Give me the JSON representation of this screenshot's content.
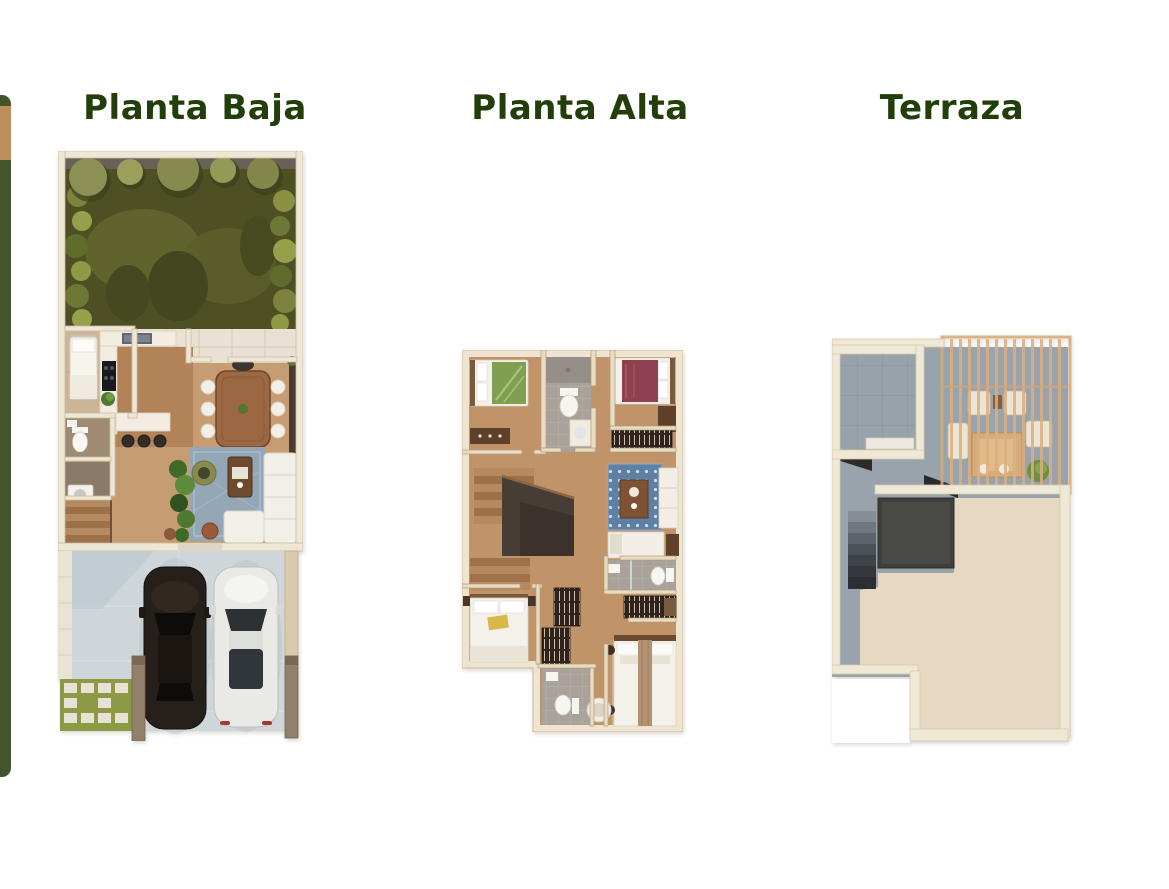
{
  "page": {
    "background": "#ffffff"
  },
  "plans": [
    {
      "id": "planta-baja",
      "title": "Planta Baja"
    },
    {
      "id": "planta-alta",
      "title": "Planta Alta"
    },
    {
      "id": "terraza",
      "title": "Terraza"
    }
  ],
  "colors": {
    "title_text": "#223f0a",
    "strip_green": "#42552b",
    "strip_tan": "#bc8e5c",
    "wall_cream": "#efe7d5",
    "wood_floor": "#c69c72",
    "garden_grass": "#4e5024",
    "driveway_concrete": "#ced6da",
    "terrace_gray": "#99a3ab",
    "terrace_beige": "#e7d8c1",
    "pergola_wood": "#d9a977",
    "rug_blue_ground": "#93a7b7",
    "rug_blue_upper": "#5d80a4"
  }
}
